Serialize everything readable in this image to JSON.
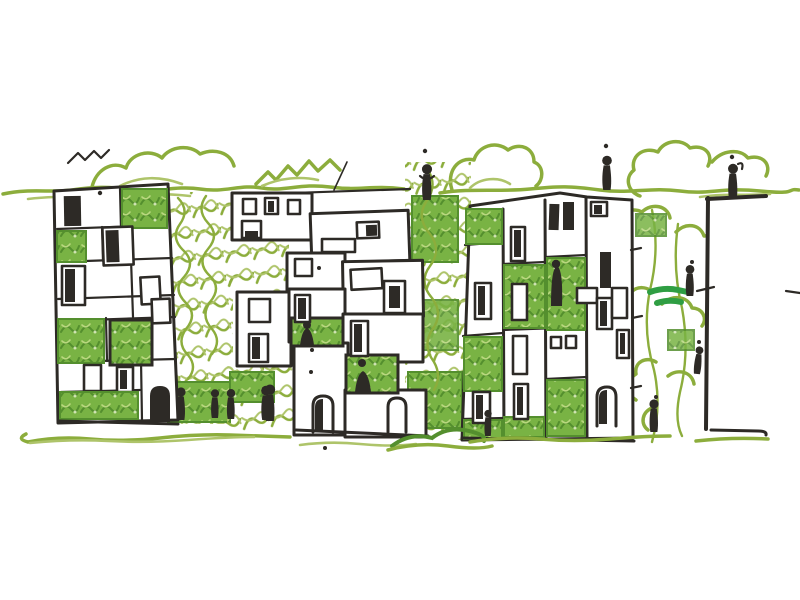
{
  "meta": {
    "description": "Freehand architectural concept sketch: three patchwork residential blocks plus a partial fourth block at the right edge, separated by vertical green-wall vegetation columns, with a scribbled tree canopy line along the top and a wavy marker ground line below.",
    "medium": "black ink pen with green marker",
    "has_text": false
  },
  "colors": {
    "ink": "#2d2a26",
    "olive": "#8cad3c",
    "oliveLight": "#aec46a",
    "leaf": "#79b344",
    "leafDark": "#548f2e",
    "leafBright": "#2f9e43",
    "paper": "#ffffff"
  },
  "scene": {
    "buildings": [
      {
        "name": "block-1",
        "position": "left",
        "style": "patchwork facade of stacked rooms",
        "green_patches": 5,
        "windows": 9,
        "doors": 1
      },
      {
        "name": "block-2",
        "position": "center-left",
        "style": "cascade of offset boxes stepping down",
        "green_patches": 3,
        "windows": 12,
        "doors": 2
      },
      {
        "name": "block-3",
        "position": "center-right",
        "style": "vertical panel facade, tilted",
        "green_patches": 7,
        "windows": 14,
        "doors": 1
      },
      {
        "name": "block-4",
        "position": "right edge, partially cropped",
        "style": "blank face, only roof and edge lines",
        "green_patches": 0,
        "windows": 0,
        "doors": 0
      }
    ],
    "vegetation": {
      "tree_line_top": "continuous wavy hedge line with cloud and zigzag tree scribbles",
      "green_columns": 3,
      "green_column_positions": [
        "between block-1 and block-2",
        "between block-2 and block-3",
        "between block-3 and block-4"
      ],
      "accent_strokes": "two darker green horizontal strokes inside right tree column"
    },
    "people": {
      "count": 14,
      "street_figures": 5,
      "balcony_figures": 3,
      "rooftop_figures": 3,
      "tree_climbing_figures": 3
    },
    "ground": "double wavy green marker line with a leafy tuft at center and a short black base line under the right block"
  }
}
